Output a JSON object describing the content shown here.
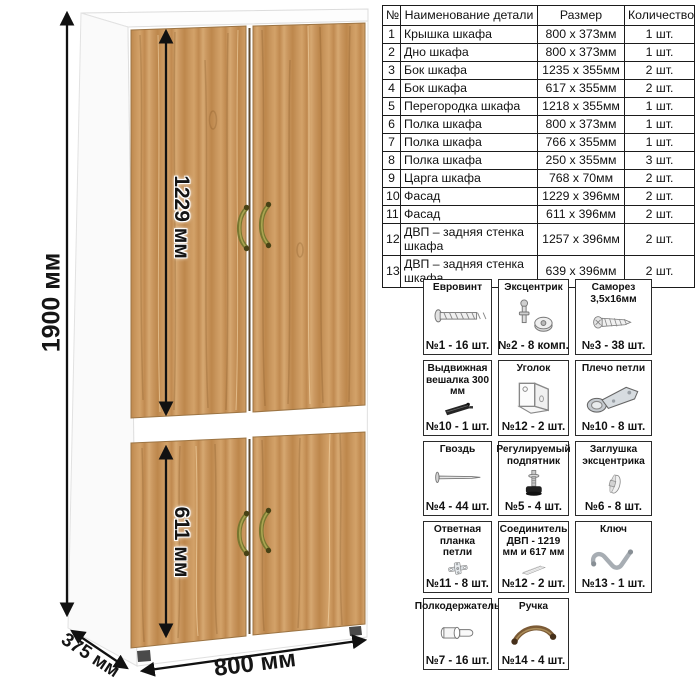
{
  "wardrobe": {
    "wood_color": "#c8955c",
    "handle_color": "#77762f",
    "dimensions": {
      "height_label": "1900 мм",
      "upper_door_label": "1229 мм",
      "lower_door_label": "611 мм",
      "width_label": "800 мм",
      "depth_label": "375 мм"
    }
  },
  "parts_table": {
    "headers": [
      "№",
      "Наименование детали",
      "Размер",
      "Количество"
    ],
    "rows": [
      {
        "num": "1",
        "name": "Крышка шкафа",
        "size": "800 x 373мм",
        "qty": "1 шт."
      },
      {
        "num": "2",
        "name": "Дно шкафа",
        "size": "800 x 373мм",
        "qty": "1 шт."
      },
      {
        "num": "3",
        "name": "Бок шкафа",
        "size": "1235 x 355мм",
        "qty": "2 шт."
      },
      {
        "num": "4",
        "name": "Бок шкафа",
        "size": "617 x 355мм",
        "qty": "2 шт."
      },
      {
        "num": "5",
        "name": "Перегородка шкафа",
        "size": "1218 x 355мм",
        "qty": "1 шт."
      },
      {
        "num": "6",
        "name": "Полка шкафа",
        "size": "800 x 373мм",
        "qty": "1 шт."
      },
      {
        "num": "7",
        "name": "Полка шкафа",
        "size": "766 x 355мм",
        "qty": "1 шт."
      },
      {
        "num": "8",
        "name": "Полка шкафа",
        "size": "250 x 355мм",
        "qty": "3 шт."
      },
      {
        "num": "9",
        "name": "Царга шкафа",
        "size": "768 x 70мм",
        "qty": "2 шт."
      },
      {
        "num": "10",
        "name": "Фасад",
        "size": "1229 x 396мм",
        "qty": "2 шт."
      },
      {
        "num": "11",
        "name": "Фасад",
        "size": "611 x 396мм",
        "qty": "2 шт."
      },
      {
        "num": "12",
        "name": "ДВП – задняя стенка шкафа",
        "size": "1257 x 396мм",
        "qty": "2 шт."
      },
      {
        "num": "13",
        "name": "ДВП – задняя стенка шкафа",
        "size": "639 x 396мм",
        "qty": "2 шт."
      }
    ]
  },
  "hardware": {
    "items": [
      {
        "title": "Евровинт",
        "count": "№1 - 16 шт.",
        "icon": "euroscrew-icon"
      },
      {
        "title": "Эксцентрик",
        "count": "№2 - 8 комп.",
        "icon": "eccentric-cam-icon"
      },
      {
        "title": "Саморез 3,5х16мм",
        "count": "№3 - 38 шт.",
        "icon": "self-tapping-screw-icon"
      },
      {
        "title": "Выдвижная вешалка 300 мм",
        "count": "№10 - 1 шт.",
        "icon": "pullout-hanger-icon"
      },
      {
        "title": "Уголок",
        "count": "№12 - 2 шт.",
        "icon": "corner-bracket-icon"
      },
      {
        "title": "Плечо петли",
        "count": "№10 - 8 шт.",
        "icon": "hinge-arm-icon"
      },
      {
        "title": "Гвоздь",
        "count": "№4 - 44 шт.",
        "icon": "nail-icon"
      },
      {
        "title": "Регулируемый подпятник",
        "count": "№5 - 4 шт.",
        "icon": "adjustable-foot-icon"
      },
      {
        "title": "Заглушка эксцентрика",
        "count": "№6 - 8 шт.",
        "icon": "cam-cover-icon"
      },
      {
        "title": "Ответная планка петли",
        "count": "№11 - 8 шт.",
        "icon": "hinge-plate-icon"
      },
      {
        "title": "Соединитель ДВП - 1219 мм и 617 мм",
        "count": "№12 - 2 шт.",
        "icon": "hdf-connector-icon"
      },
      {
        "title": "Ключ",
        "count": "№13 - 1 шт.",
        "icon": "hex-key-icon"
      },
      {
        "title": "Полкодержатель",
        "count": "№7 - 16 шт.",
        "icon": "shelf-pin-icon"
      },
      {
        "title": "Ручка",
        "count": "№14 - 4 шт.",
        "icon": "furniture-handle-icon"
      }
    ]
  }
}
